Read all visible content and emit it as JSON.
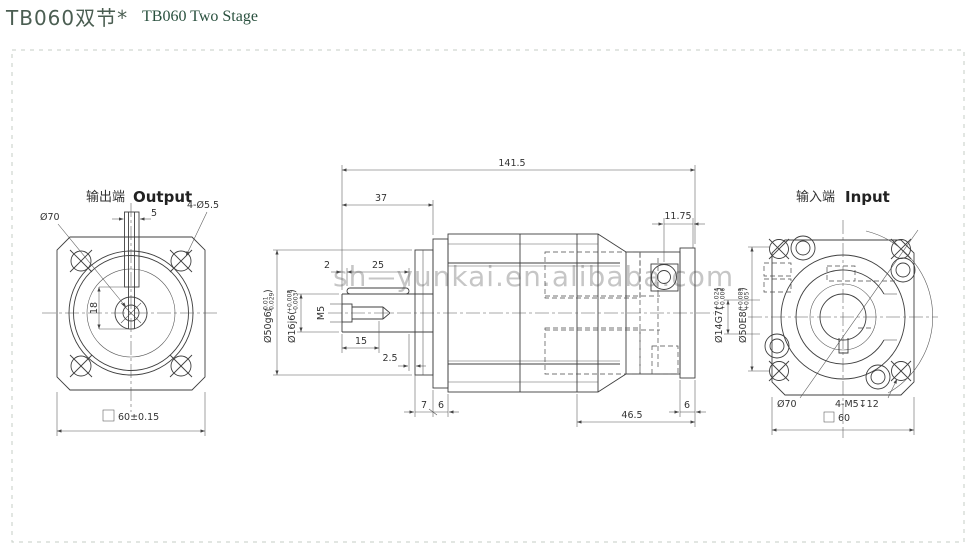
{
  "title": {
    "model_cn": "TB060双节*",
    "model_en": "TB060 Two Stage"
  },
  "watermark": "sh—yunkai.en.alibaba.com",
  "output_view": {
    "heading_cn": "输出端",
    "heading_en": "Output",
    "dims": {
      "pilot_dia": "Ø70",
      "corner_holes": "4-Ø5.5",
      "key_width": "5",
      "key_depth": "18",
      "square_size": "60±0.15"
    }
  },
  "section_view": {
    "dims": {
      "total_length": "141.5",
      "shaft_length": "37",
      "screw_offset": "11.75",
      "key_offset": "2",
      "key_length": "25",
      "thread": "M5",
      "thread_depth": "15",
      "key_end_gap": "2.5",
      "boss_width": "7",
      "flange_width": "6",
      "input_length": "46.5",
      "end_width": "6"
    },
    "tolerances": {
      "shaft": {
        "main": "Ø16j6(",
        "upper": "+0.008",
        "lower": "-0.003"
      },
      "boss": {
        "main": "Ø50g6(",
        "upper": "-0.01",
        "lower": "-0.029"
      },
      "input_bore": {
        "main": "Ø14G7(",
        "upper": "+0.024",
        "lower": "+0.006"
      },
      "input_spigot": {
        "main": "Ø50E8(",
        "upper": "+0.089",
        "lower": "+0.05"
      },
      "close": ")"
    }
  },
  "input_view": {
    "heading_cn": "输入端",
    "heading_en": "Input",
    "dims": {
      "pilot_dia": "Ø70",
      "tapped_holes": "4-M5↧12",
      "square_size": "60"
    }
  }
}
